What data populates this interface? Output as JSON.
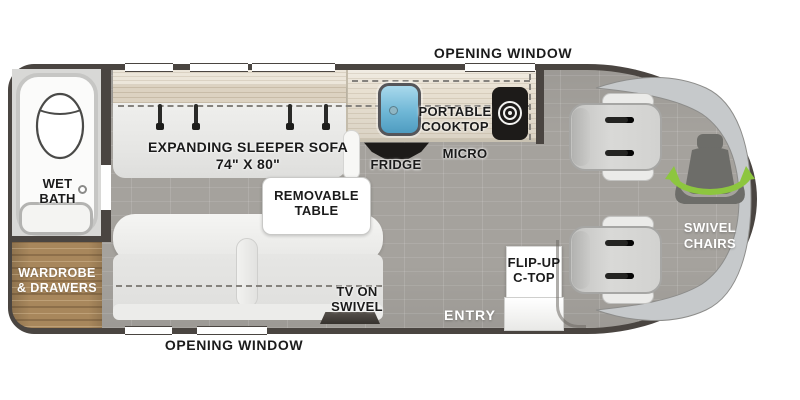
{
  "floorplan": {
    "windows": {
      "top_label": "OPENING WINDOW",
      "bottom_label": "OPENING WINDOW"
    },
    "bath": {
      "line1": "WET",
      "line2": "BATH"
    },
    "wardrobe": {
      "line1": "WARDROBE",
      "line2": "& DRAWERS"
    },
    "sleeper_sofa": {
      "line1": "EXPANDING SLEEPER SOFA",
      "line2": "74\" X 80\""
    },
    "kitchen": {
      "cooktop_line1": "PORTABLE",
      "cooktop_line2": "COOKTOP",
      "fridge": "FRIDGE",
      "micro": "MICRO",
      "flip_up_line1": "FLIP-UP",
      "flip_up_line2": "C-TOP"
    },
    "table": {
      "line1": "REMOVABLE",
      "line2": "TABLE"
    },
    "tv": {
      "line1": "TV ON",
      "line2": "SWIVEL"
    },
    "entry": {
      "label": "ENTRY"
    },
    "cab": {
      "line1": "SWIVEL",
      "line2": "CHAIRS"
    }
  },
  "colors": {
    "outline": "#4a4541",
    "floor_tile": "#a5a29d",
    "wood_cabinet": "#a8875c",
    "counter_wood": "#e8e0d1",
    "upholstery": "#e9e9e7",
    "swivel_arrow_green": "#8dc63f",
    "sink_blue": "#6fb7d6",
    "appliance_black": "#1d1b19",
    "windshield_gray": "#c6c9cb"
  },
  "icons": {
    "toilet": "toilet-icon",
    "sink": "sink-icon",
    "burner": "burner-icon",
    "seatbelt": "seatbelt-icon",
    "swivel_seat": "swivel-seat-icon",
    "swivel_arrows": "swivel-arrows-icon"
  }
}
